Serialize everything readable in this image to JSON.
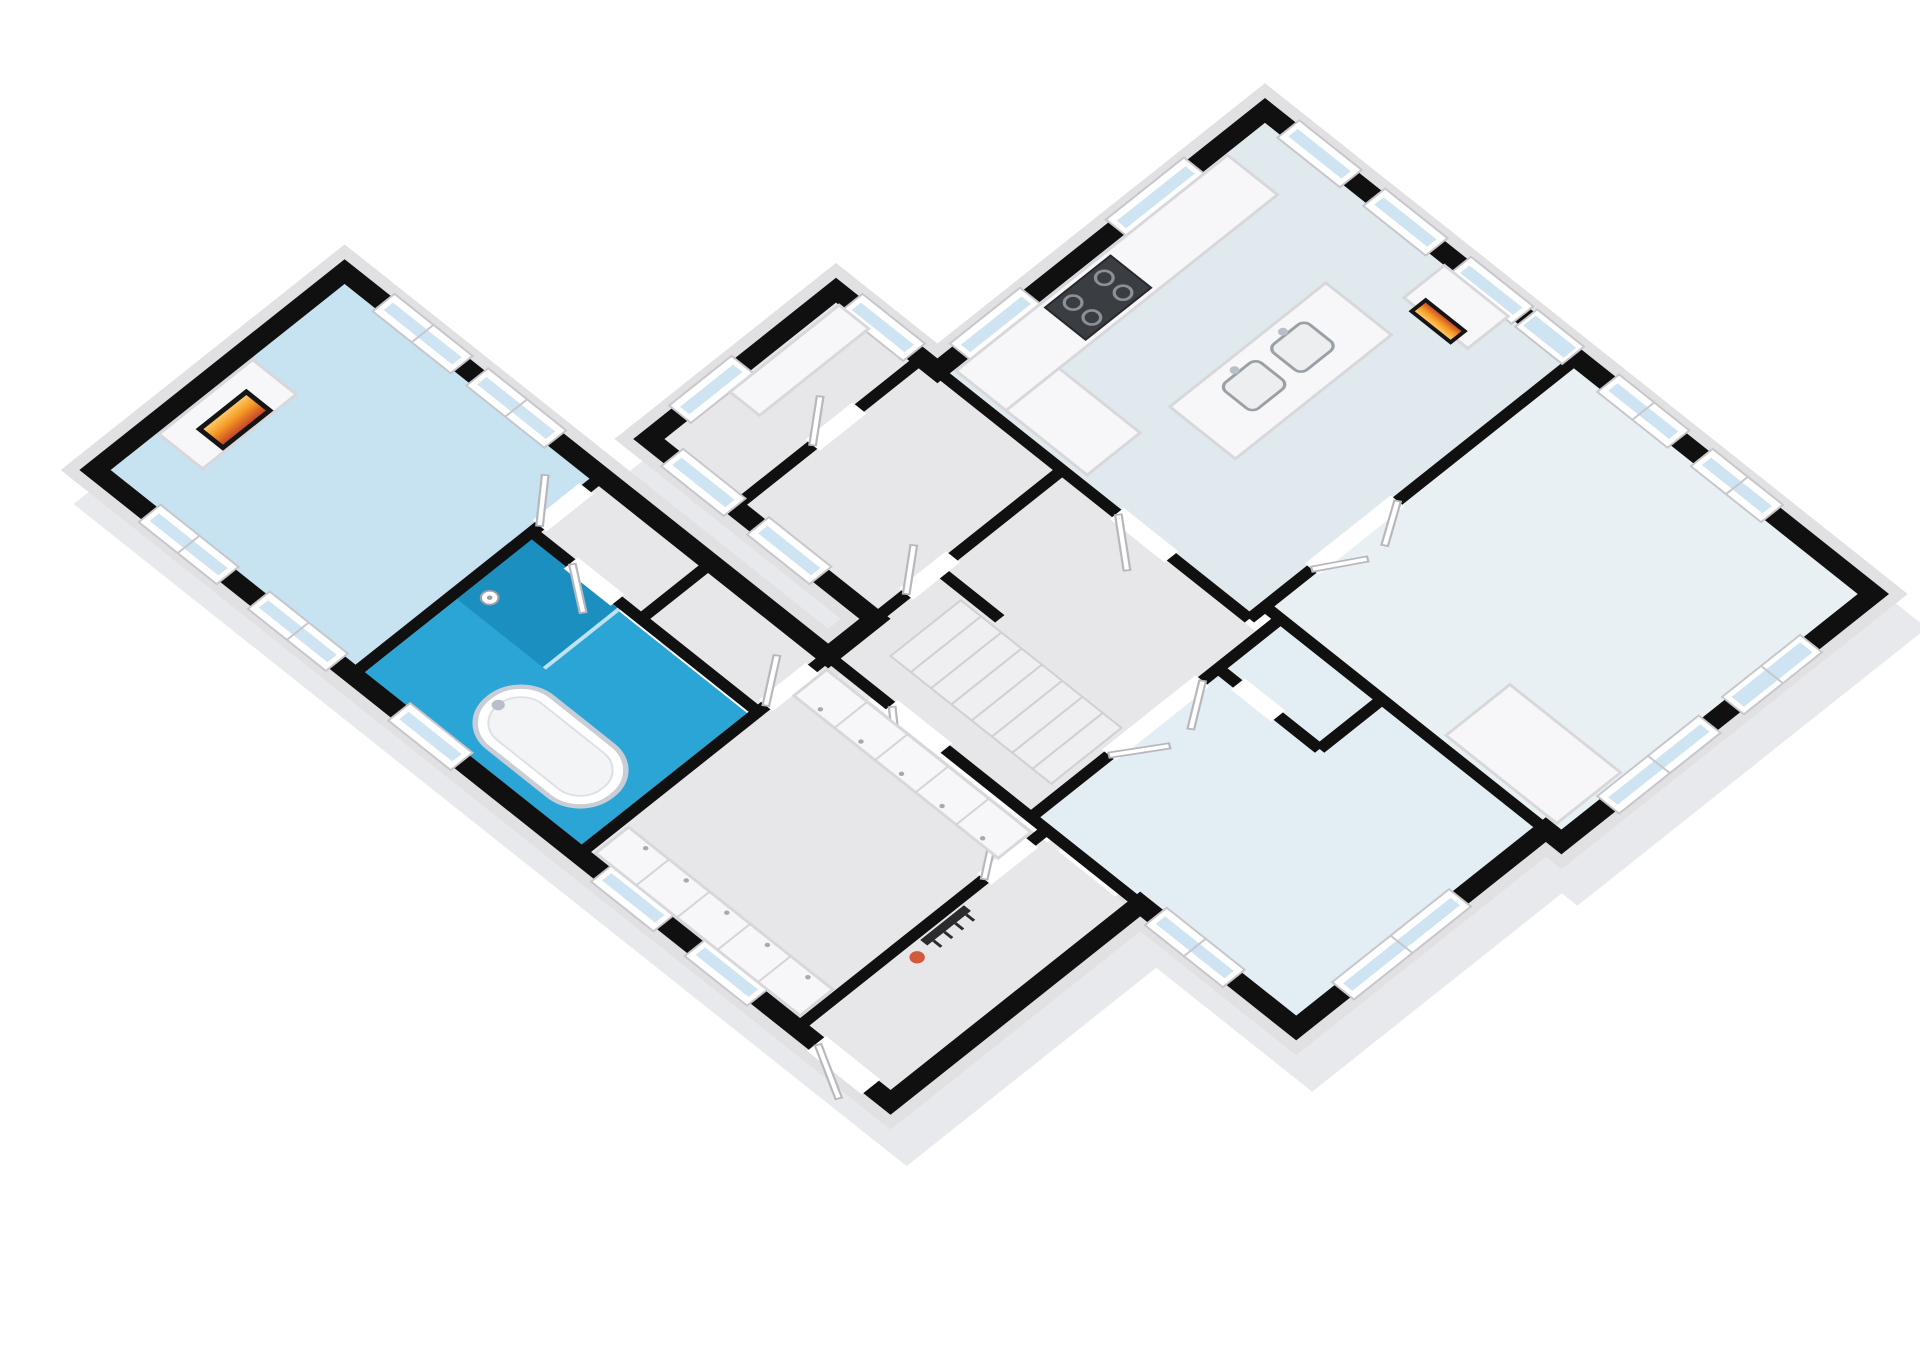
{
  "meta": {
    "title": "3D isometric cutaway floor plan render",
    "view": "dollhouse top-down isometric, walls cut in black, white background",
    "visible_text": "none"
  },
  "palette": {
    "background": "#ffffff",
    "wall_cut": "#101010",
    "wall_outer_face": "#e1e1e4",
    "wall_shadow": "#c9ccd2",
    "floor_gray": "#e7e7ea",
    "floor_living": "#c7e2f1",
    "floor_bathroom": "#2ba4d6",
    "shower_blue": "#1b8fc0",
    "floor_kitchen": "#dfe9ee",
    "floor_bedroom_west": "#e3edf4",
    "floor_bedroom_east": "#e8f0f4",
    "window_glass": "#cfe4f2",
    "fire_hot": "#ffd27a",
    "fire_mid": "#f59b23",
    "fire_ember": "#c0392b",
    "plant_accent": "#d4593c",
    "stove_top": "#3a3d42"
  },
  "rooms": [
    {
      "id": "living-room",
      "label": "Living room (north-west wing)",
      "floor": "#c7e2f1",
      "features": [
        "fireplace with chimney block",
        "two windows west wall",
        "two windows east wall"
      ]
    },
    {
      "id": "bathroom",
      "label": "Bathroom",
      "floor": "#2ba4d6",
      "features": [
        "freestanding bathtub",
        "walk-in shower with glass",
        "shower head",
        "window"
      ]
    },
    {
      "id": "wc",
      "label": "WC",
      "floor": "#e7e7ea",
      "features": [
        "door"
      ]
    },
    {
      "id": "nook",
      "label": "Hall nook",
      "floor": "#e7e7ea",
      "features": []
    },
    {
      "id": "dressing-corridor",
      "label": "Dressing corridor",
      "floor": "#e7e7ea",
      "features": [
        "wardrobe bank west",
        "wardrobe bank east",
        "two windows"
      ]
    },
    {
      "id": "vestibule",
      "label": "Entrance vestibule",
      "floor": "#e7e7ea",
      "features": [
        "front door",
        "coat rack",
        "orange plant"
      ]
    },
    {
      "id": "storage-north",
      "label": "Storage room north tip",
      "floor": "#e7e7ea",
      "features": [
        "shelf block",
        "window"
      ]
    },
    {
      "id": "storage-south",
      "label": "Storage room",
      "floor": "#e7e7ea",
      "features": [
        "two windows west"
      ]
    },
    {
      "id": "hallway",
      "label": "Central hall",
      "floor": "#e7e7ea",
      "features": [
        "staircase 8 treads"
      ]
    },
    {
      "id": "kitchen",
      "label": "Kitchen",
      "floor": "#dfe9ee",
      "features": [
        "L-counter",
        "4-burner stove",
        "island with two sinks",
        "fireplace column",
        "three windows east",
        "two windows north",
        "glazed door"
      ]
    },
    {
      "id": "bedroom-west",
      "label": "Bedroom south-west",
      "floor": "#e3edf4",
      "features": [
        "double doors",
        "windows",
        "en-suite stalls"
      ]
    },
    {
      "id": "living-dining-east",
      "label": "Living / dining south-east",
      "floor": "#e8f0f4",
      "features": [
        "cabinet block",
        "double doors to kitchen",
        "French door",
        "windows"
      ]
    }
  ],
  "fixtures": [
    "fireplace-living",
    "fireplace-kitchen",
    "bathtub",
    "shower",
    "kitchen-island",
    "sink",
    "sink",
    "stove",
    "staircase",
    "wardrobes",
    "cabinet-block",
    "shelf-block",
    "coat-rack",
    "plant"
  ],
  "counts": {
    "windows": 20,
    "fireplaces": 2,
    "stair_treads": 8,
    "sinks": 2,
    "stove_burners": 4
  }
}
